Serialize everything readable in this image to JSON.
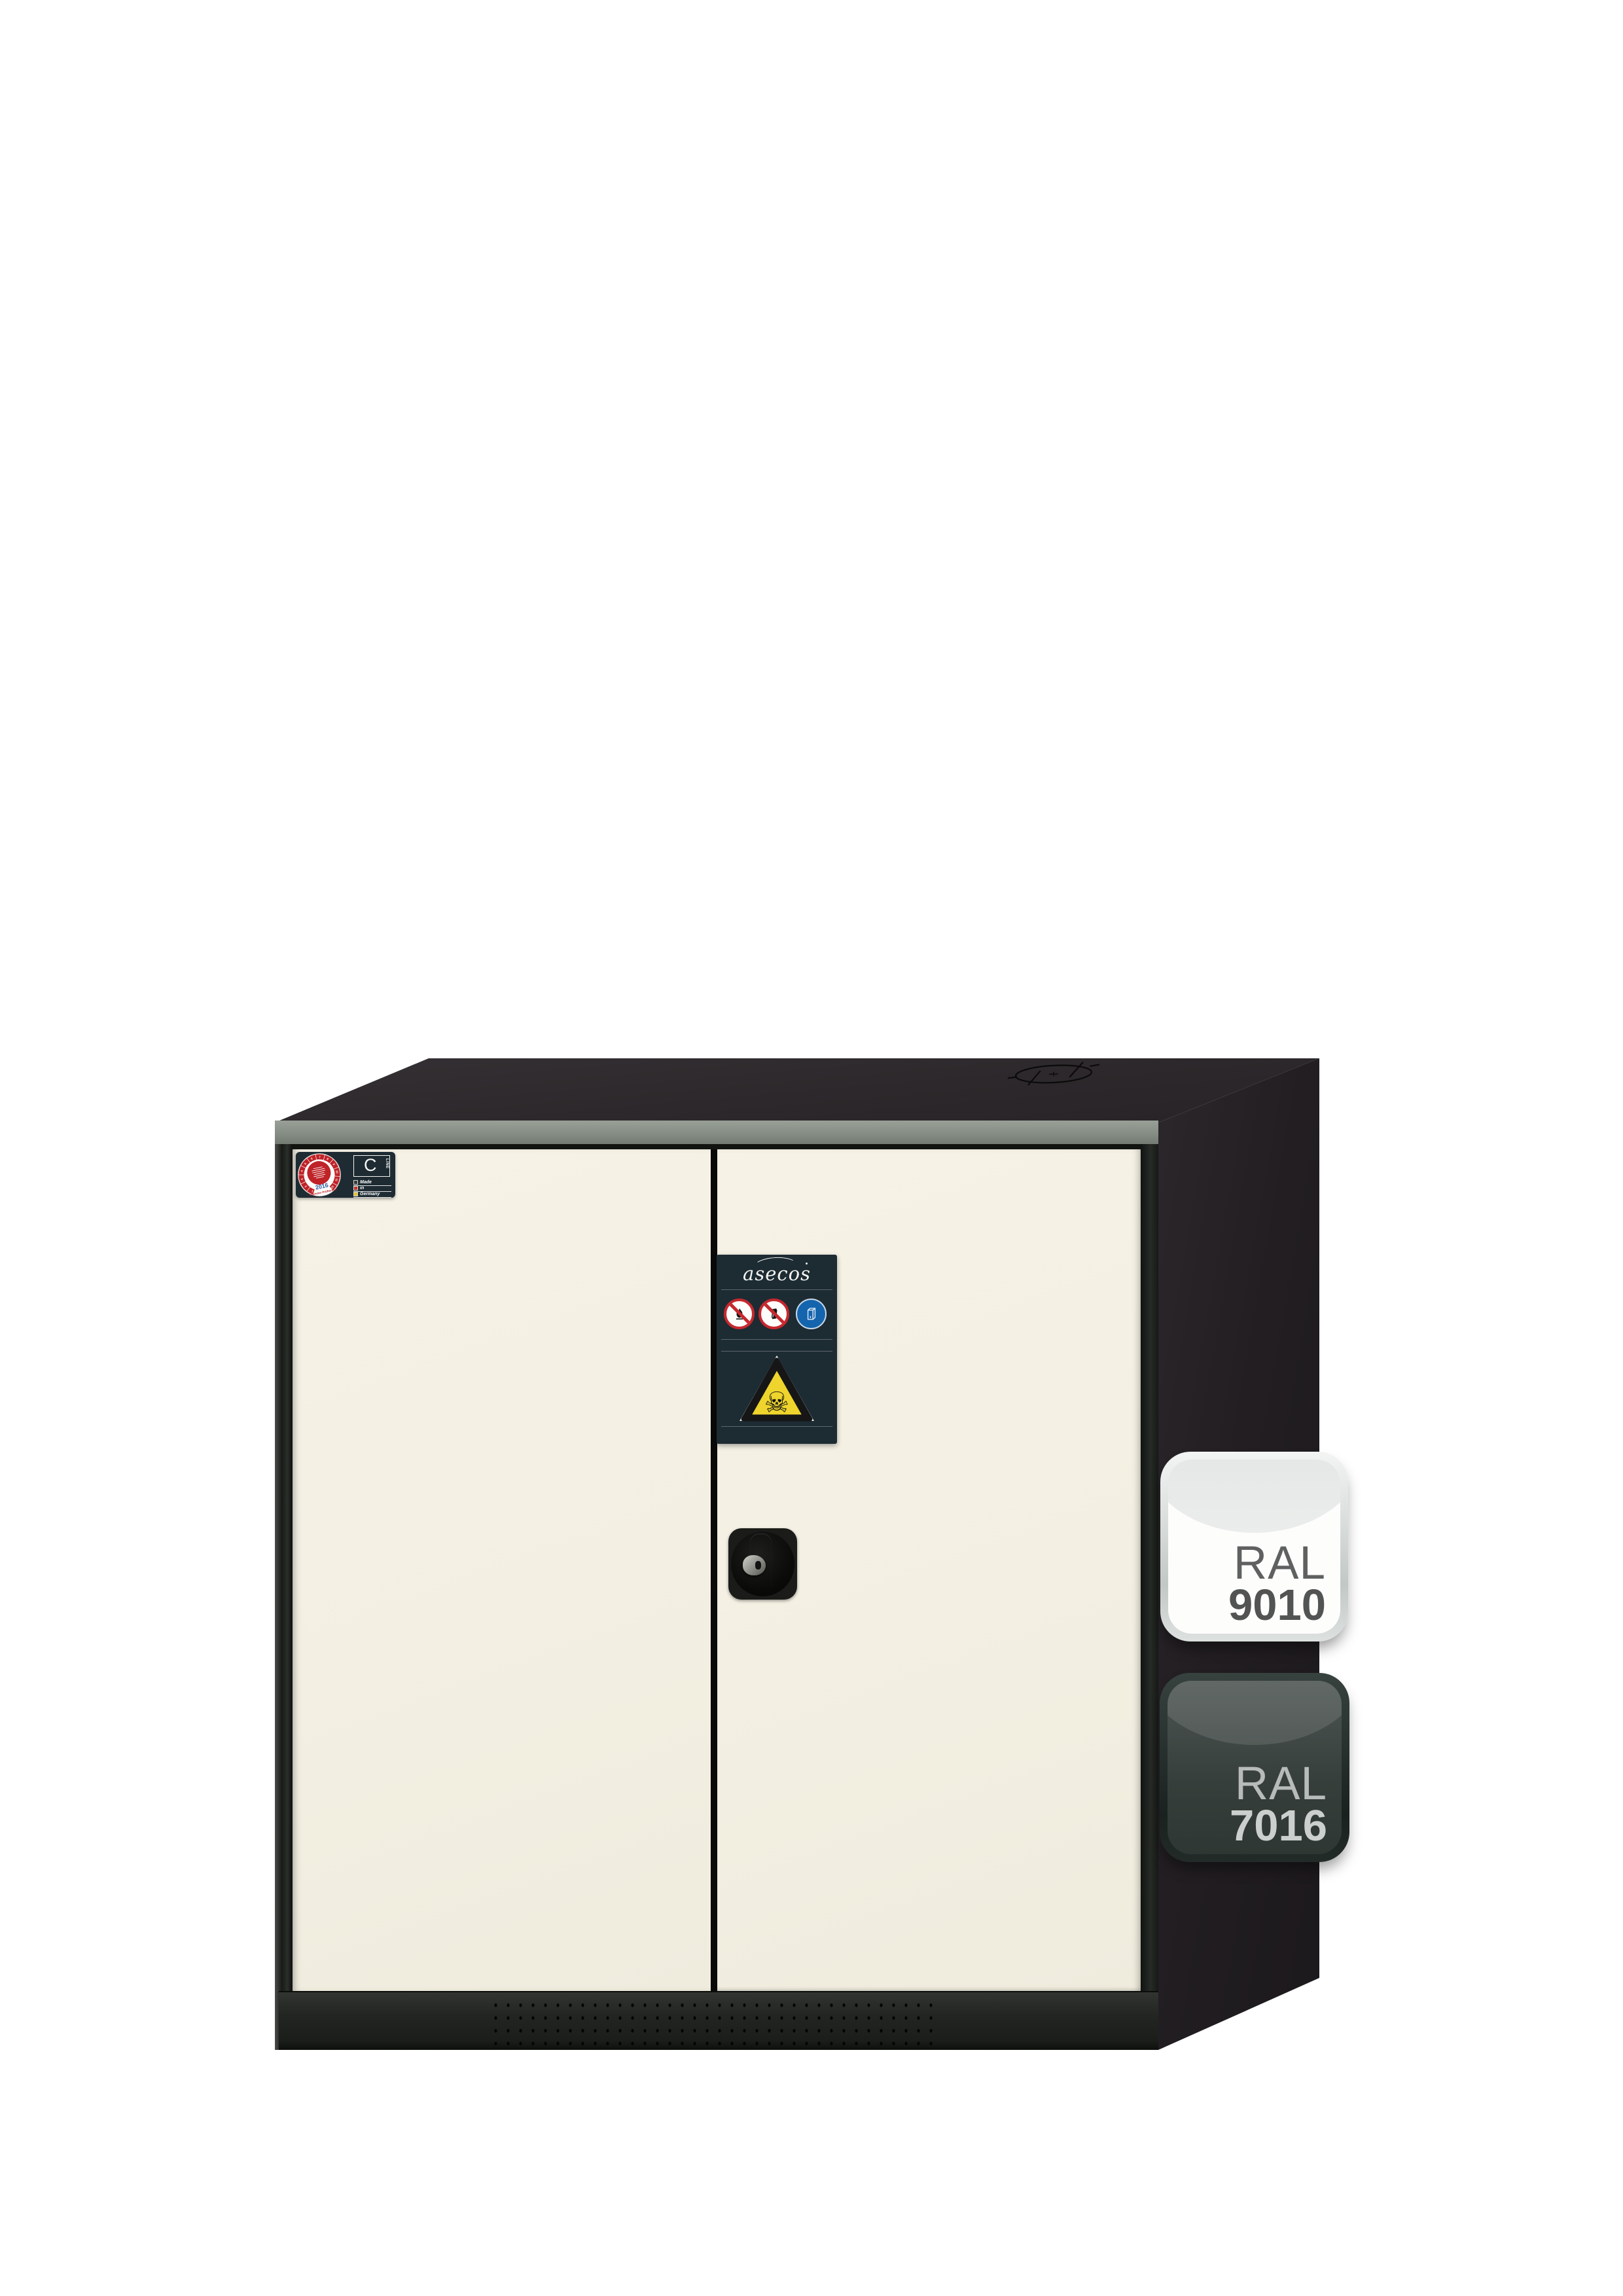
{
  "product": {
    "type": "chemical-safety-cabinet",
    "body_color_hex": "#2c282b",
    "door_color_hex": "#f3efe2"
  },
  "inspection_label": {
    "seal": {
      "numbers": [
        "1",
        "2",
        "3",
        "4",
        "5",
        "6",
        "7",
        "8",
        "9",
        "10",
        "11",
        "12"
      ],
      "year": "2016",
      "caption": "Nächster Prüftermin",
      "ring_color": "#bf2328",
      "year_color": "#2b5aa5"
    },
    "product_line": {
      "letter": "C",
      "suffix": "LINE"
    },
    "made_in": {
      "line1": "Made",
      "line2": "in",
      "line3": "Germany"
    }
  },
  "brand_label": {
    "brand": "asecos",
    "background": "#1d2b33",
    "pictograms": [
      {
        "name": "no-open-flame-icon",
        "type": "prohibition",
        "color": "#c5282e"
      },
      {
        "name": "no-fire-door-icon",
        "type": "prohibition",
        "color": "#c5282e"
      },
      {
        "name": "keep-cabinet-closed-icon",
        "type": "mandatory",
        "color": "#1565ae"
      }
    ],
    "warning": {
      "name": "toxic-warning",
      "symbol": "☠",
      "field_color": "#eed42c"
    }
  },
  "ral_badges": [
    {
      "prefix": "RAL",
      "code": "9010",
      "variant": "light",
      "swatch_hex": "#f1ece1"
    },
    {
      "prefix": "RAL",
      "code": "7016",
      "variant": "dark",
      "swatch_hex": "#383e3a"
    }
  ]
}
